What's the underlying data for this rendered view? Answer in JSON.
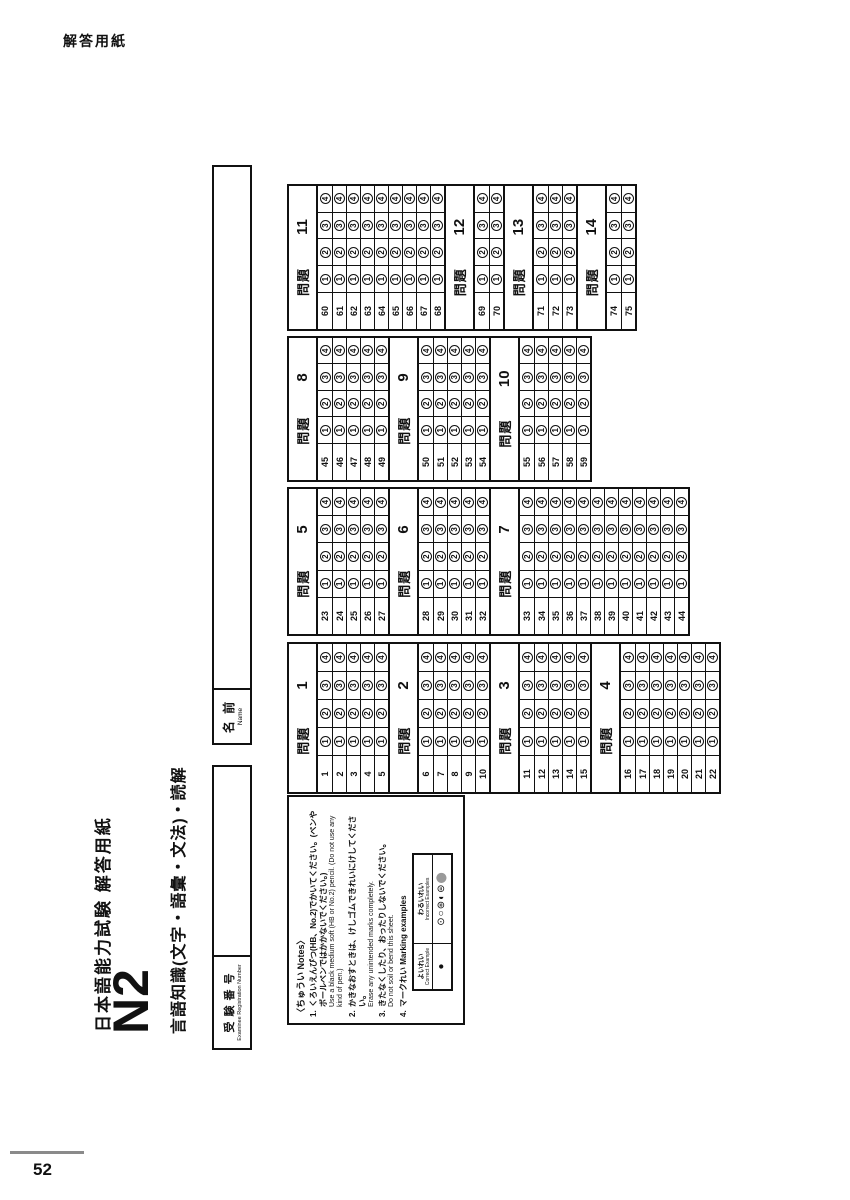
{
  "page": {
    "corner_label": "解答用紙",
    "page_number": "52"
  },
  "header": {
    "title": "日本語能力試験 解答用紙",
    "level": "N2",
    "subtitle": "言語知識(文字・語彙・文法)・読解"
  },
  "fields": {
    "examinee_number": {
      "label_ja": "受 験 番 号",
      "label_en": "Examinee Registration Number",
      "value": ""
    },
    "name": {
      "label_ja": "名 前",
      "label_en": "Name",
      "value": ""
    }
  },
  "notes": {
    "heading": "〈ちゅうい Notes〉",
    "items": [
      {
        "num": "1.",
        "ja": "くろいえんぴつ(HB、No.2)でかいてください。(ペンやボールペンではかかないでください。)",
        "en": "Use a black medium soft (HB or No.2) pencil. (Do not use any kind of pen.)"
      },
      {
        "num": "2.",
        "ja": "かきなおすときは、けしゴムできれいにけしてください。",
        "en": "Erase any unintended marks completely."
      },
      {
        "num": "3.",
        "ja": "きたなくしたり、おったりしないでください。",
        "en": "Do not soil or bend this sheet."
      },
      {
        "num": "4.",
        "ja": "マークれい Marking examples",
        "en": ""
      }
    ],
    "marking": {
      "correct_label_ja": "よいれい",
      "correct_label_en": "Correct Example",
      "incorrect_label_ja": "わるいれい",
      "incorrect_label_en": "Incorrect Examples",
      "correct_mark": "●",
      "incorrect_marks": [
        "⊙",
        "○",
        "⊛",
        "◐",
        "⊜",
        "⬤"
      ]
    }
  },
  "answer_grid": {
    "options": [
      "1",
      "2",
      "3",
      "4"
    ],
    "columns": [
      {
        "sections": [
          {
            "label": "問題",
            "number": "1",
            "rows": [
              "1",
              "2",
              "3",
              "4",
              "5"
            ]
          },
          {
            "label": "問題",
            "number": "2",
            "rows": [
              "6",
              "7",
              "8",
              "9",
              "10"
            ]
          },
          {
            "label": "問題",
            "number": "3",
            "rows": [
              "11",
              "12",
              "13",
              "14",
              "15"
            ]
          },
          {
            "label": "問題",
            "number": "4",
            "rows": [
              "16",
              "17",
              "18",
              "19",
              "20",
              "21",
              "22"
            ]
          }
        ]
      },
      {
        "sections": [
          {
            "label": "問題",
            "number": "5",
            "rows": [
              "23",
              "24",
              "25",
              "26",
              "27"
            ]
          },
          {
            "label": "問題",
            "number": "6",
            "rows": [
              "28",
              "29",
              "30",
              "31",
              "32"
            ]
          },
          {
            "label": "問題",
            "number": "7",
            "rows": [
              "33",
              "34",
              "35",
              "36",
              "37",
              "38",
              "39",
              "40",
              "41",
              "42",
              "43",
              "44"
            ]
          }
        ]
      },
      {
        "sections": [
          {
            "label": "問題",
            "number": "8",
            "rows": [
              "45",
              "46",
              "47",
              "48",
              "49"
            ]
          },
          {
            "label": "問題",
            "number": "9",
            "rows": [
              "50",
              "51",
              "52",
              "53",
              "54"
            ]
          },
          {
            "label": "問題",
            "number": "10",
            "rows": [
              "55",
              "56",
              "57",
              "58",
              "59"
            ]
          }
        ]
      },
      {
        "sections": [
          {
            "label": "問題",
            "number": "11",
            "rows": [
              "60",
              "61",
              "62",
              "63",
              "64",
              "65",
              "66",
              "67",
              "68"
            ]
          },
          {
            "label": "問題",
            "number": "12",
            "rows": [
              "69",
              "70"
            ]
          },
          {
            "label": "問題",
            "number": "13",
            "rows": [
              "71",
              "72",
              "73"
            ]
          },
          {
            "label": "問題",
            "number": "14",
            "rows": [
              "74",
              "75"
            ]
          }
        ]
      }
    ]
  },
  "colors": {
    "ink": "#111111",
    "footer_line": "#8a8a8a",
    "incorrect_gray": "#9a9a9a"
  }
}
